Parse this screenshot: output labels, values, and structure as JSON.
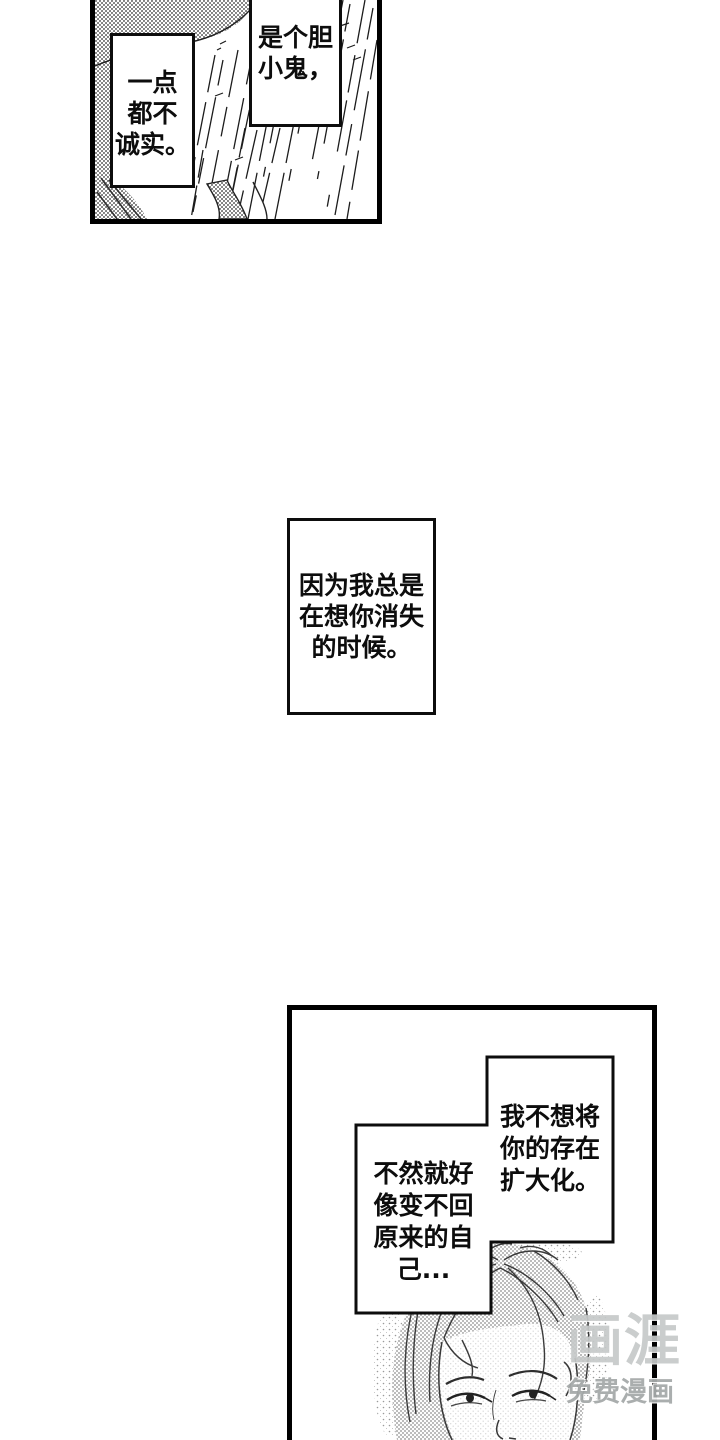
{
  "bubbles": {
    "coward": {
      "lines": [
        "是个胆",
        "小鬼，"
      ]
    },
    "dishonest": {
      "lines": [
        "一点",
        "都不",
        "诚实。"
      ]
    },
    "narration": {
      "lines": [
        "因为我总是",
        "在想你消失",
        "的时候。"
      ]
    },
    "expand": {
      "lines": [
        "我不想将",
        "你的存在",
        "扩大化。"
      ]
    },
    "revert": {
      "lines": [
        "不然就好",
        "像变不回",
        "原来的自",
        "己..."
      ]
    }
  },
  "watermark": {
    "logo": "画涯",
    "tagline": "免费漫画",
    "logo_color": "#c6c9c9",
    "tagline_color": "#a6aaaa"
  },
  "colors": {
    "ink": "#0d0d0d",
    "panel_border": "#000000",
    "halftone_dot": "#6e6e6e"
  }
}
